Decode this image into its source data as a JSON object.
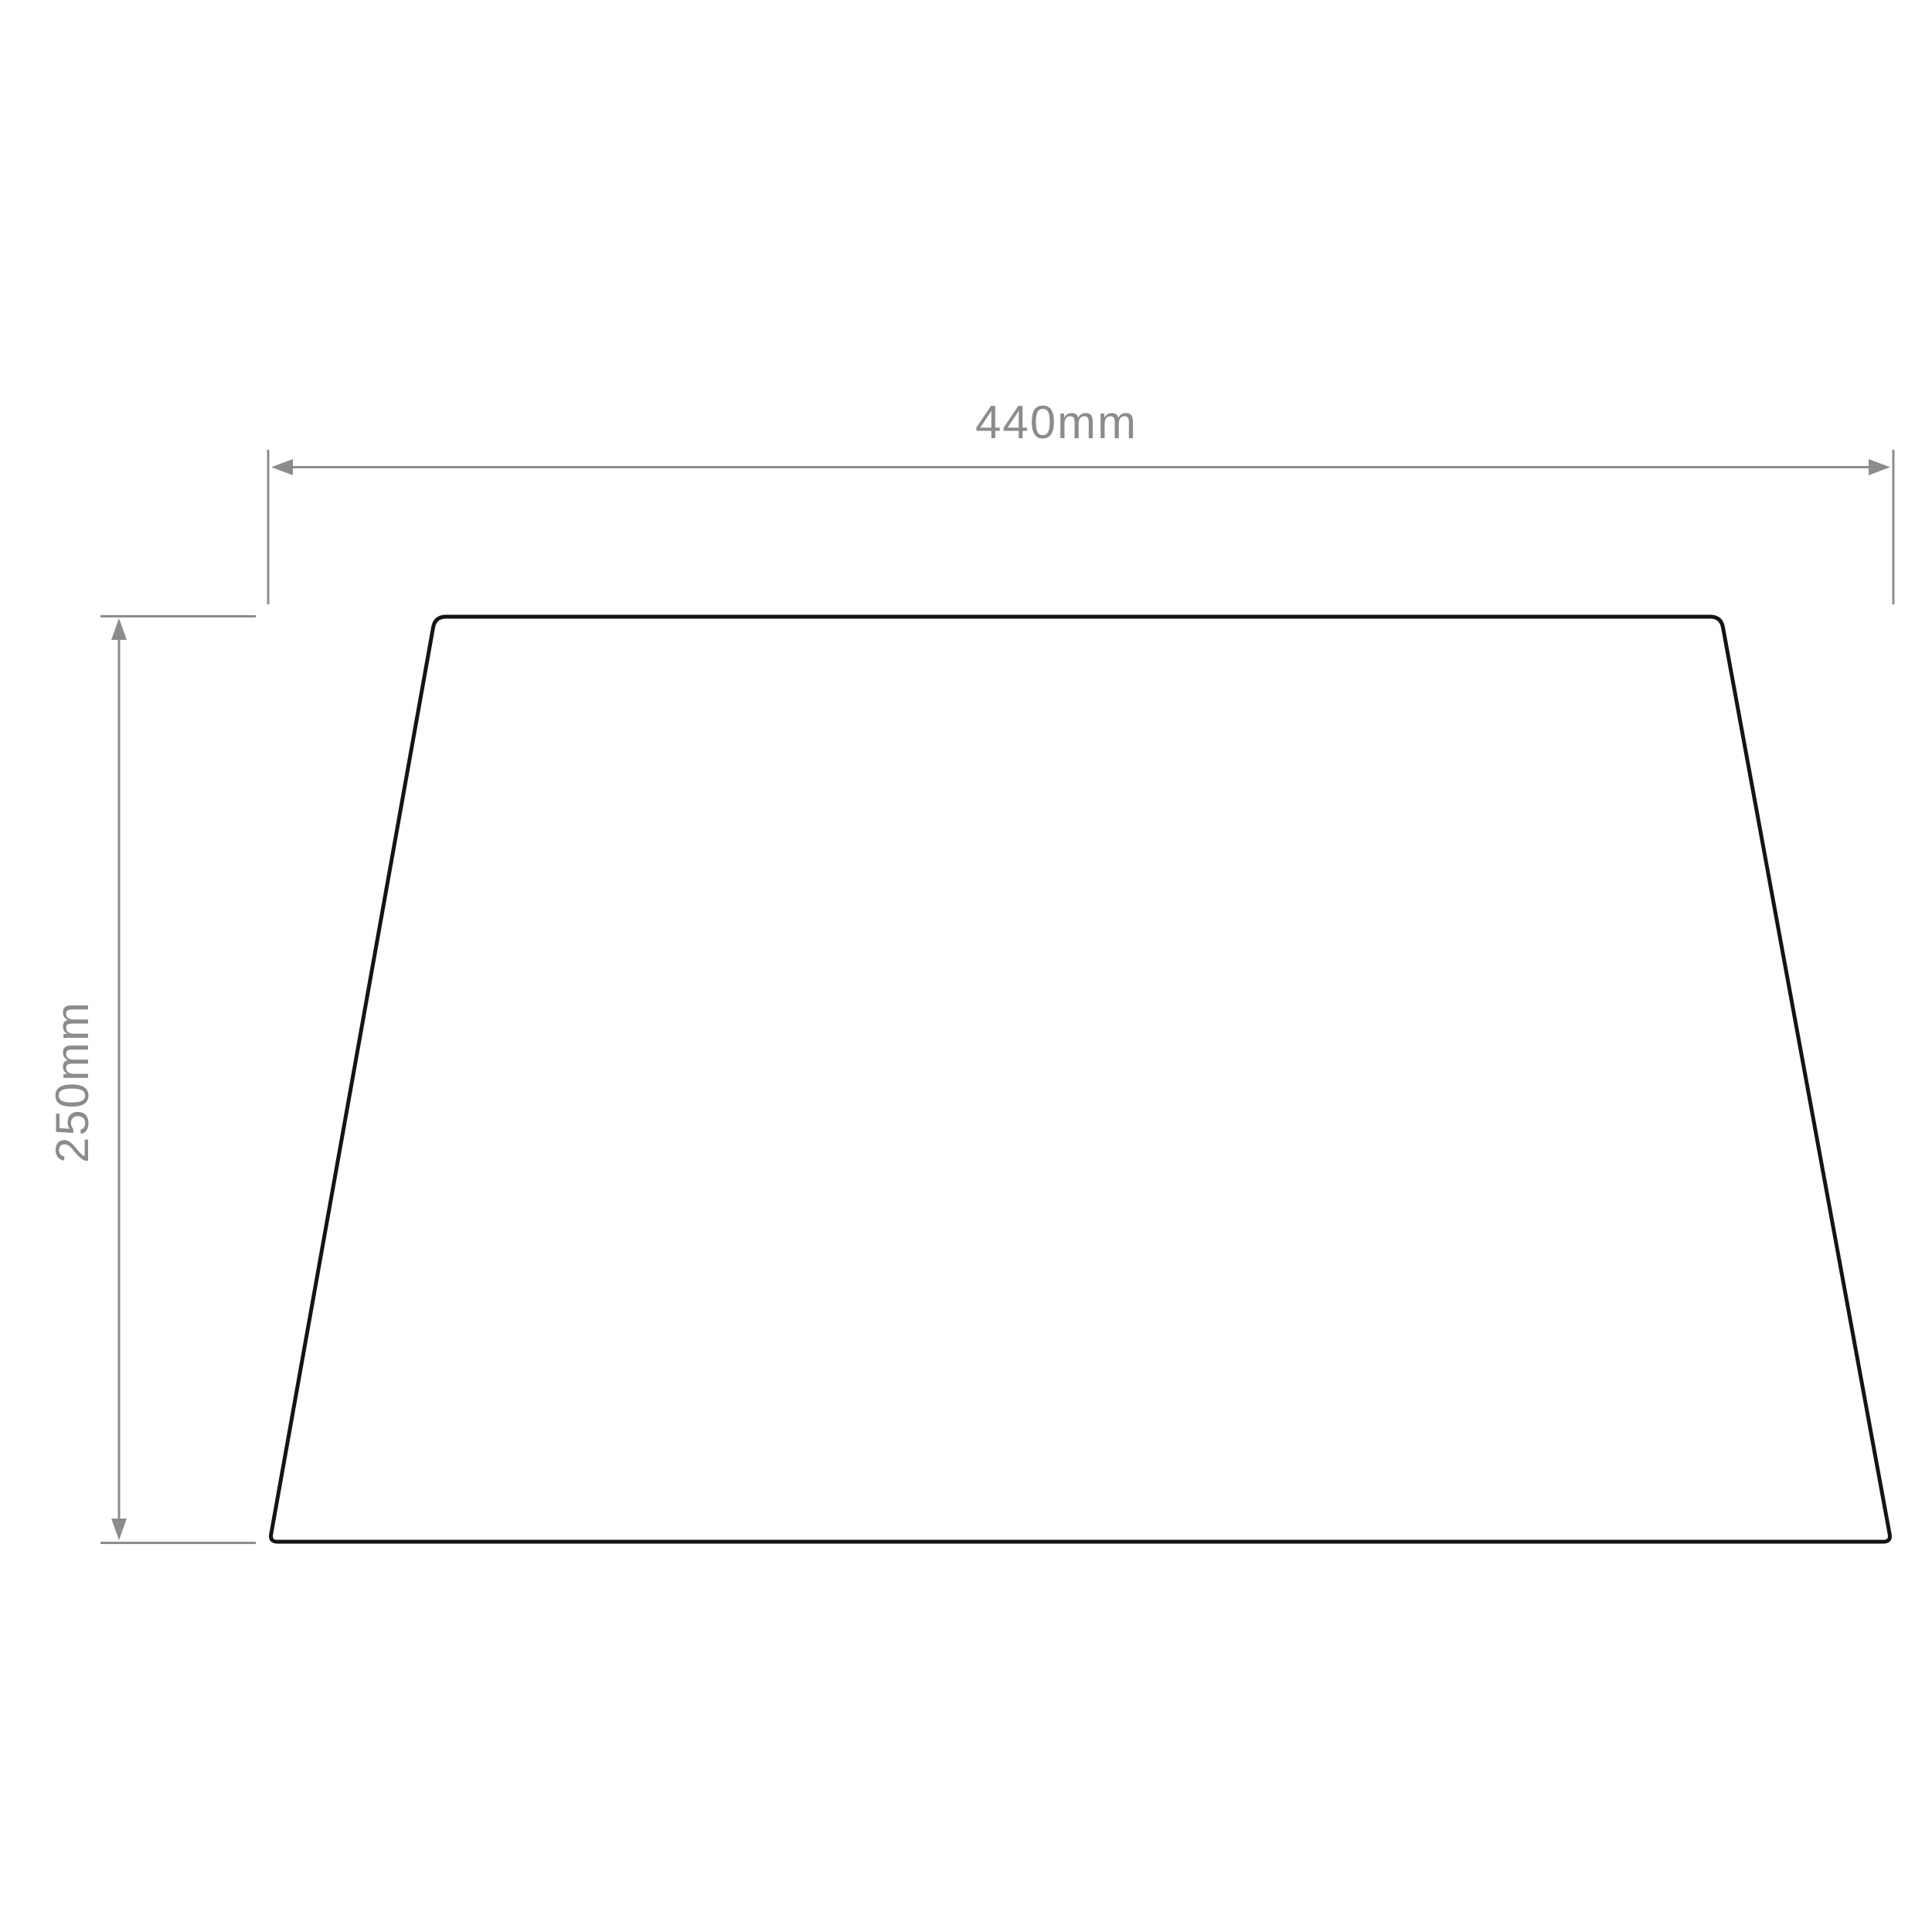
{
  "diagram": {
    "width_dimension": {
      "label": "440mm"
    },
    "height_dimension": {
      "label": "250mm"
    }
  },
  "colors": {
    "dimension_gray": "#8c8c8c",
    "outline_black": "#141414",
    "background": "#ffffff"
  }
}
